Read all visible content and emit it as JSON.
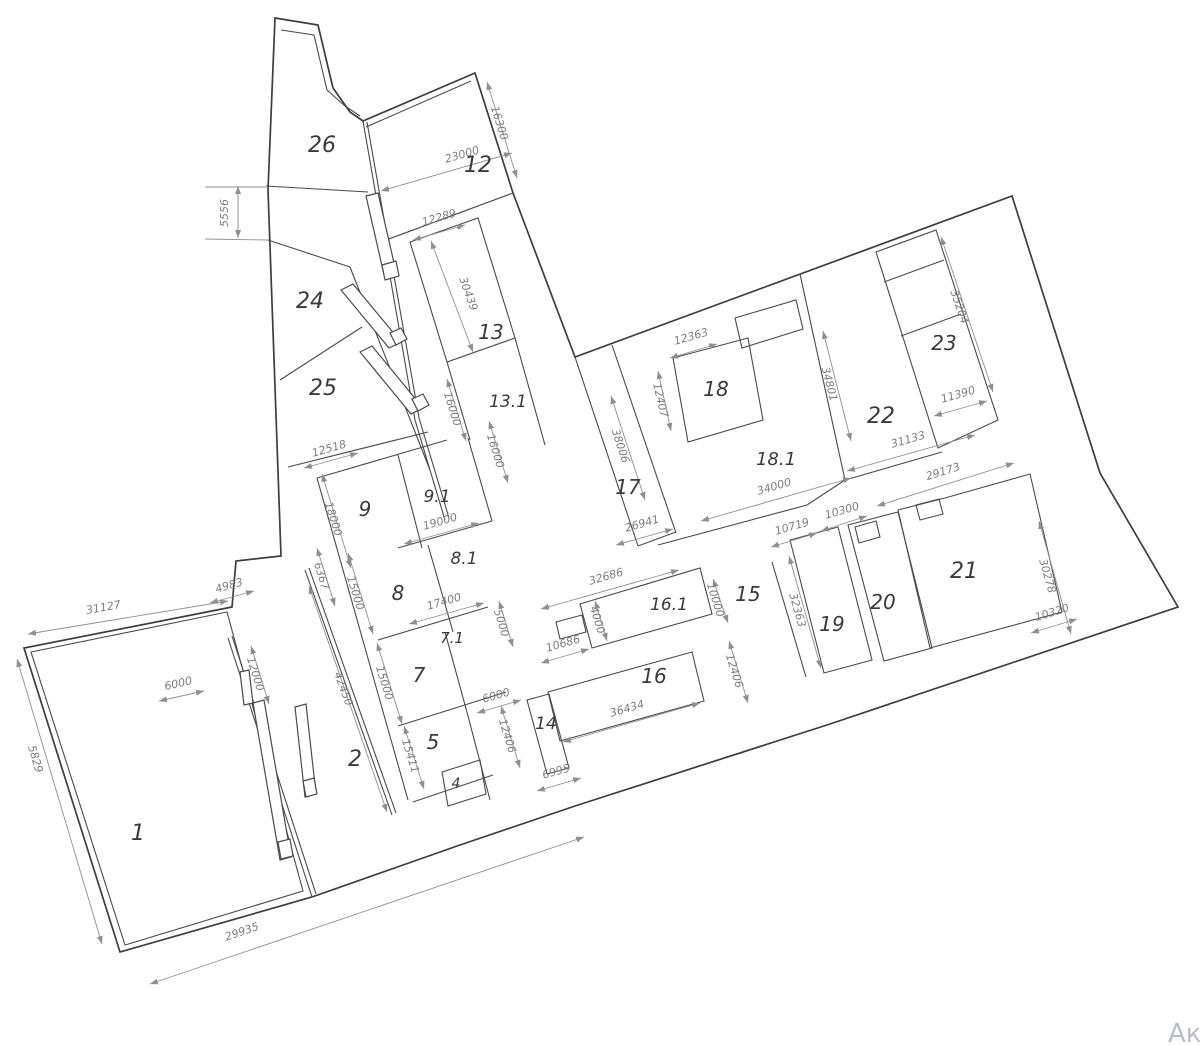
{
  "page": {
    "background": "#ffffff",
    "watermark": "Ак"
  },
  "drawing": {
    "type": "cadastral-site-plan",
    "units": "mm",
    "line_color": "#3d3d3d",
    "dimension_color": "#8a8a8a",
    "zones": [
      {
        "label": "26"
      },
      {
        "label": "12"
      },
      {
        "label": "24"
      },
      {
        "label": "25"
      },
      {
        "label": "13"
      },
      {
        "label": "13.1"
      },
      {
        "label": "9"
      },
      {
        "label": "9.1"
      },
      {
        "label": "8"
      },
      {
        "label": "8.1"
      },
      {
        "label": "7.1"
      },
      {
        "label": "7"
      },
      {
        "label": "5"
      },
      {
        "label": "4"
      },
      {
        "label": "2"
      },
      {
        "label": "1"
      },
      {
        "label": "14"
      },
      {
        "label": "16"
      },
      {
        "label": "16.1"
      },
      {
        "label": "15"
      },
      {
        "label": "17"
      },
      {
        "label": "18"
      },
      {
        "label": "18.1"
      },
      {
        "label": "19"
      },
      {
        "label": "20"
      },
      {
        "label": "21"
      },
      {
        "label": "22"
      },
      {
        "label": "23"
      }
    ],
    "dimensions": [
      {
        "value": "16300"
      },
      {
        "value": "23000"
      },
      {
        "value": "12289"
      },
      {
        "value": "30439"
      },
      {
        "value": "5556"
      },
      {
        "value": "12518"
      },
      {
        "value": "18000"
      },
      {
        "value": "16000"
      },
      {
        "value": "16000"
      },
      {
        "value": "19000"
      },
      {
        "value": "17400"
      },
      {
        "value": "15000"
      },
      {
        "value": "15000"
      },
      {
        "value": "5000"
      },
      {
        "value": "6367"
      },
      {
        "value": "4983"
      },
      {
        "value": "31127"
      },
      {
        "value": "12000"
      },
      {
        "value": "6000"
      },
      {
        "value": "5829"
      },
      {
        "value": "29935"
      },
      {
        "value": "42450"
      },
      {
        "value": "15411"
      },
      {
        "value": "6000"
      },
      {
        "value": "12406"
      },
      {
        "value": "12406"
      },
      {
        "value": "6995"
      },
      {
        "value": "36434"
      },
      {
        "value": "10686"
      },
      {
        "value": "4000"
      },
      {
        "value": "32686"
      },
      {
        "value": "10000"
      },
      {
        "value": "34000"
      },
      {
        "value": "10719"
      },
      {
        "value": "10300"
      },
      {
        "value": "32363"
      },
      {
        "value": "29173"
      },
      {
        "value": "30278"
      },
      {
        "value": "10320"
      },
      {
        "value": "12363"
      },
      {
        "value": "12407"
      },
      {
        "value": "38006"
      },
      {
        "value": "26941"
      },
      {
        "value": "34801"
      },
      {
        "value": "35204"
      },
      {
        "value": "11390"
      },
      {
        "value": "31133"
      }
    ]
  }
}
